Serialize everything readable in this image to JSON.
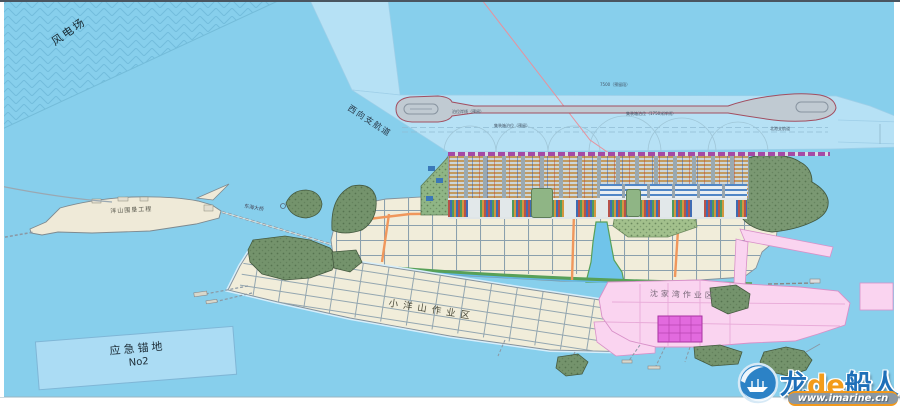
{
  "map": {
    "labels": {
      "wind_farm": "风电场",
      "west_channel": "西向支航道",
      "reclamation": "洋山围垦工程",
      "bridge": "东海大桥",
      "anchorage_name": "应急锚地",
      "anchorage_no": "No2",
      "xiaoyangshan": "小洋山作业区",
      "shenjiawan": "沈家湾作业区"
    },
    "annotations": {
      "reserved_segment": "7500（预留段）",
      "quay_reserved": "泊位岸线（预留）",
      "berth_reserved": "集装箱泊位（预留）",
      "berth_line": "集装箱泊位（1750米岸线）",
      "north_channel": "北港支航道"
    },
    "colors": {
      "water": "#87cfec",
      "channel_basin": "#b6e1f5",
      "land": "#f1edda",
      "road": "#8ba0ad",
      "orange_road": "#f0975c",
      "pink_area": "#fad4f0",
      "magenta_block": "#e26ade",
      "green_hill": "#74936c",
      "container_tan": "#c29a60",
      "crane_magenta": "#a44aa6"
    }
  },
  "watermark": {
    "brand_prefix": "龙",
    "brand_mid": "de",
    "brand_suffix": "船人",
    "url": "www.imarine.cn"
  }
}
